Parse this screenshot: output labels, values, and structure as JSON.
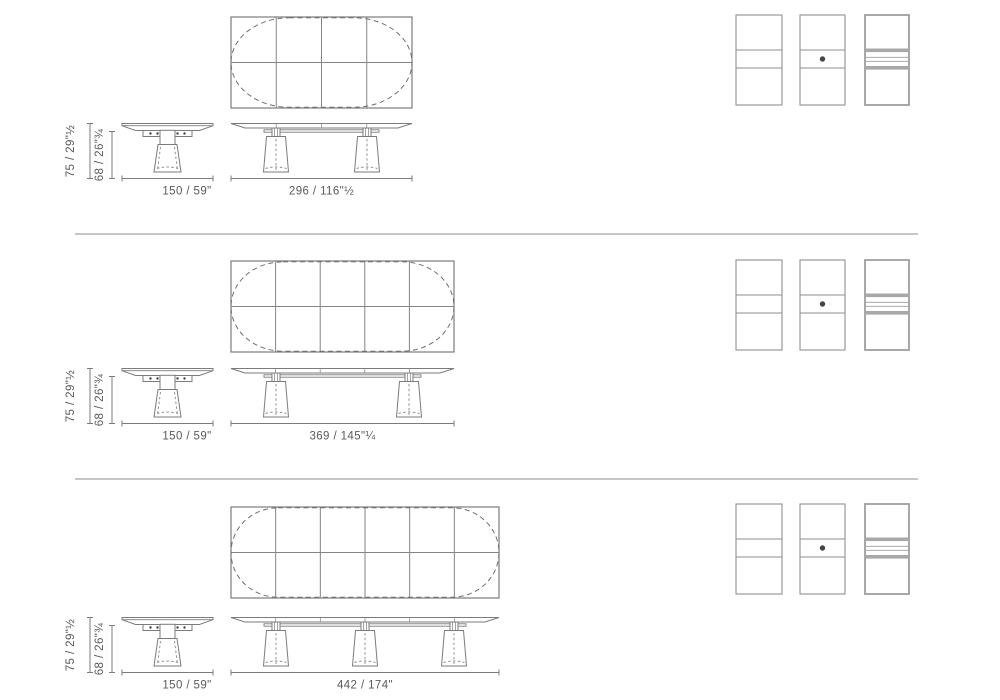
{
  "document": {
    "kind": "extending-table-dimension-sheet",
    "rows_count": 3
  },
  "colors": {
    "line": "#7b7b7b",
    "grid": "#848484",
    "dash": "#6e6e6e",
    "dash_light": "#919191",
    "text": "#5a5a5a",
    "divider": "#8e8e8e",
    "swatch_border": "#8f8f8f",
    "swatch_border_thick": "#9e9e9e",
    "swatch_bar": "#a8a8a8",
    "dot": "#454545"
  },
  "rows": [
    {
      "variant": "table-296",
      "plan": {
        "columns": 4,
        "rows": 2,
        "outline": "dashed-oval"
      },
      "legs": 2,
      "dims": {
        "height_total": "75 / 29\"½",
        "height_clearance": "68 / 26\"¾",
        "round_width": "150 / 59\"",
        "long_width": "296 / 116\"½"
      }
    },
    {
      "variant": "table-369",
      "plan": {
        "columns": 5,
        "rows": 2,
        "outline": "dashed-oval"
      },
      "legs": 2,
      "dims": {
        "height_total": "75 / 29\"½",
        "height_clearance": "68 / 26\"¾",
        "round_width": "150 / 59\"",
        "long_width": "369 / 145\"¼"
      }
    },
    {
      "variant": "table-442",
      "plan": {
        "columns": 6,
        "rows": 2,
        "outline": "dashed-oval"
      },
      "legs": 3,
      "dims": {
        "height_total": "75 / 29\"½",
        "height_clearance": "68 / 26\"¾",
        "round_width": "150 / 59\"",
        "long_width": "442 / 174\""
      }
    }
  ],
  "swatches": [
    {
      "name": "top-panel-plain"
    },
    {
      "name": "top-panel-dot"
    },
    {
      "name": "top-panel-extension-leaves"
    }
  ]
}
